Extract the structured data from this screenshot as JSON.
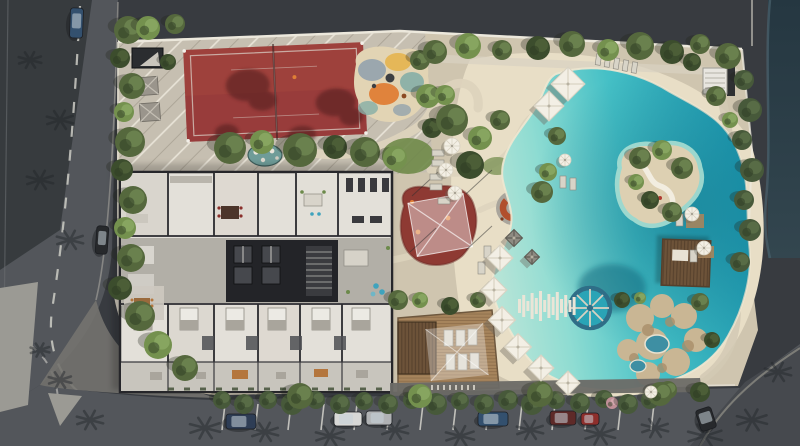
{
  "scene": {
    "kind": "aerial-architectural-rendering",
    "summary": "Top-down render of a residential amenity site: red sports court, playground, cut-away apartment floor plan, shade structures, fire-pit lounge, lagoon-style pool with island and round water feature, sun deck, rock grotto spa, perimeter streets with parked cars"
  },
  "labels": {
    "root": "aerial-site-render",
    "left_street": "left-street",
    "bottom_street": "bottom-street",
    "court": "sports-court",
    "playground": "playground",
    "pond": "pebble-pond",
    "shed": "garden-shed",
    "gazebos": "garden-gazebos",
    "building": "apartment-floorplan-cutaway",
    "red_canopy": "kids-play-area-shade-canopy",
    "firepit": "fire-pit-lounge",
    "pool": "lagoon-pool",
    "island": "pool-island",
    "wheel": "round-pool-feature",
    "planks": "plank-boardwalk",
    "grotto": "rock-grotto-spa",
    "pergola": "pergola",
    "deck": "sun-deck",
    "stairs": "stair-pavilion",
    "water": "waterway",
    "parking": "street-parking",
    "trees": "trees-and-shrubs",
    "cars": "parked-cars"
  },
  "palette": {
    "bgDark": "#383b40",
    "roofShadow": "#2f3237",
    "roadGrey": "#53565b",
    "roadShadow": "#33363a",
    "sidewalk": "#8f8e8a",
    "plaza": "#9b9a94",
    "waterStrip": "#2b3c46",
    "sand": "#cfc5af",
    "sandLight": "#ddd3bd",
    "pavingNW": "#c6bfb1",
    "beach": "#e8dec6",
    "courtRed": "#9e413c",
    "courtShadow": "#4f1f1d",
    "shedDark": "#2b2d30",
    "pondTeal": "#6f9c98",
    "playOrange": "#df7e36",
    "playTeal": "#86aea6",
    "playYellow": "#e6b44e",
    "playBlue": "#93a2ad",
    "redBlob": "#8e3a33",
    "firepitOrange": "#b14f2d",
    "poolShallow": "#bfe6d8",
    "poolMid": "#45c0c6",
    "poolDeep": "#1b96ae",
    "islandSand": "#ddd0b2",
    "wheelRim": "#2f6e87",
    "wheelFill": "#2aa4b6",
    "plankWhite": "#eae5d7",
    "rockTan": "#c9b694",
    "deckWood": "#a6845c",
    "pergolaBrown": "#6d5339",
    "canopyWhite": "#f3efe5",
    "canopyGrey": "#8e8b82",
    "bldgRoom": "#e3e0d9",
    "bldgWall": "#26262a",
    "corridor": "#b2afa7",
    "coreDark": "#232428",
    "terrace": "#c8c5bd",
    "treeMid": "#55683d",
    "treeLight": "#74914e",
    "treeDark": "#3c4d2d",
    "hedge": "#47593a",
    "lawn": "#6f8a49",
    "carNavy": "#2e3d55",
    "carWhite": "#d8d8d6",
    "carSilver": "#b0b2b4",
    "carBlue": "#33506e",
    "carRed": "#8e2f2c",
    "carDarkRed": "#5e2a28",
    "carDark": "#27292c",
    "lineWhite": "#cdccc6"
  },
  "trees": [
    [
      128,
      30,
      14,
      "m"
    ],
    [
      120,
      58,
      10,
      "d"
    ],
    [
      132,
      86,
      13,
      "m"
    ],
    [
      124,
      112,
      10,
      "l"
    ],
    [
      130,
      142,
      15,
      "m"
    ],
    [
      122,
      170,
      11,
      "d"
    ],
    [
      133,
      200,
      14,
      "m"
    ],
    [
      125,
      228,
      11,
      "l"
    ],
    [
      131,
      258,
      14,
      "m"
    ],
    [
      120,
      288,
      12,
      "d"
    ],
    [
      140,
      316,
      15,
      "m"
    ],
    [
      158,
      345,
      14,
      "l"
    ],
    [
      185,
      368,
      13,
      "m"
    ],
    [
      148,
      28,
      12,
      "l"
    ],
    [
      175,
      24,
      10,
      "m"
    ],
    [
      168,
      62,
      8,
      "d"
    ],
    [
      230,
      148,
      16,
      "m"
    ],
    [
      262,
      142,
      12,
      "l"
    ],
    [
      300,
      150,
      17,
      "m"
    ],
    [
      335,
      147,
      12,
      "d"
    ],
    [
      365,
      152,
      15,
      "m"
    ],
    [
      395,
      158,
      12,
      "l"
    ],
    [
      420,
      60,
      10,
      "m"
    ],
    [
      428,
      96,
      12,
      "l"
    ],
    [
      432,
      128,
      10,
      "d"
    ],
    [
      435,
      52,
      12,
      "m"
    ],
    [
      468,
      46,
      13,
      "l"
    ],
    [
      502,
      50,
      10,
      "m"
    ],
    [
      538,
      48,
      12,
      "d"
    ],
    [
      572,
      44,
      13,
      "m"
    ],
    [
      608,
      50,
      11,
      "l"
    ],
    [
      640,
      46,
      14,
      "m"
    ],
    [
      672,
      52,
      12,
      "d"
    ],
    [
      700,
      44,
      10,
      "m"
    ],
    [
      728,
      56,
      13,
      "m"
    ],
    [
      452,
      120,
      16,
      "m"
    ],
    [
      480,
      138,
      12,
      "l"
    ],
    [
      470,
      165,
      14,
      "d"
    ],
    [
      445,
      95,
      10,
      "l"
    ],
    [
      500,
      120,
      10,
      "m"
    ],
    [
      542,
      192,
      11,
      "m"
    ],
    [
      548,
      172,
      9,
      "l"
    ],
    [
      557,
      136,
      9,
      "m"
    ],
    [
      744,
      80,
      10,
      "h"
    ],
    [
      750,
      110,
      12,
      "h"
    ],
    [
      742,
      140,
      10,
      "h"
    ],
    [
      752,
      170,
      12,
      "h"
    ],
    [
      744,
      200,
      10,
      "h"
    ],
    [
      750,
      230,
      11,
      "h"
    ],
    [
      740,
      262,
      10,
      "h"
    ],
    [
      692,
      62,
      9,
      "d"
    ],
    [
      716,
      96,
      10,
      "m"
    ],
    [
      730,
      120,
      8,
      "l"
    ],
    [
      640,
      158,
      11,
      "m"
    ],
    [
      662,
      150,
      10,
      "l"
    ],
    [
      682,
      168,
      11,
      "m"
    ],
    [
      650,
      200,
      9,
      "d"
    ],
    [
      672,
      212,
      10,
      "m"
    ],
    [
      636,
      182,
      8,
      "l"
    ],
    [
      622,
      300,
      8,
      "d"
    ],
    [
      700,
      302,
      9,
      "m"
    ],
    [
      712,
      340,
      8,
      "d"
    ],
    [
      668,
      390,
      9,
      "m"
    ],
    [
      640,
      298,
      6,
      "l"
    ],
    [
      398,
      300,
      10,
      "m"
    ],
    [
      420,
      300,
      8,
      "l"
    ],
    [
      450,
      306,
      9,
      "d"
    ],
    [
      478,
      300,
      8,
      "m"
    ],
    [
      222,
      400,
      9,
      "h"
    ],
    [
      244,
      404,
      10,
      "h"
    ],
    [
      268,
      400,
      9,
      "h"
    ],
    [
      292,
      404,
      11,
      "h"
    ],
    [
      316,
      400,
      9,
      "h"
    ],
    [
      340,
      404,
      10,
      "h"
    ],
    [
      364,
      401,
      9,
      "h"
    ],
    [
      388,
      404,
      10,
      "h"
    ],
    [
      412,
      400,
      9,
      "h"
    ],
    [
      436,
      404,
      11,
      "h"
    ],
    [
      460,
      401,
      9,
      "h"
    ],
    [
      484,
      404,
      10,
      "h"
    ],
    [
      508,
      400,
      10,
      "h"
    ],
    [
      532,
      404,
      11,
      "h"
    ],
    [
      556,
      400,
      9,
      "h"
    ],
    [
      580,
      403,
      10,
      "h"
    ],
    [
      604,
      399,
      9,
      "h"
    ],
    [
      612,
      403,
      6,
      "p"
    ],
    [
      628,
      404,
      10,
      "h"
    ],
    [
      650,
      400,
      9,
      "h"
    ],
    [
      300,
      396,
      13,
      "m"
    ],
    [
      420,
      396,
      12,
      "l"
    ],
    [
      540,
      394,
      13,
      "m"
    ],
    [
      660,
      394,
      12,
      "m"
    ],
    [
      700,
      392,
      10,
      "d"
    ]
  ],
  "palm_shadows": [
    [
      205,
      428,
      16
    ],
    [
      265,
      432,
      14
    ],
    [
      330,
      436,
      15
    ],
    [
      395,
      430,
      14
    ],
    [
      460,
      436,
      15
    ],
    [
      530,
      430,
      14
    ],
    [
      600,
      434,
      16
    ],
    [
      655,
      428,
      14
    ],
    [
      705,
      436,
      18
    ],
    [
      752,
      420,
      16
    ],
    [
      778,
      372,
      14
    ],
    [
      60,
      380,
      12
    ],
    [
      90,
      420,
      14
    ],
    [
      40,
      350,
      10
    ],
    [
      60,
      120,
      14
    ],
    [
      40,
      180,
      14
    ],
    [
      70,
      240,
      14
    ],
    [
      30,
      60,
      12
    ]
  ],
  "cars": [
    {
      "x": 70,
      "y": 8,
      "w": 13,
      "h": 30,
      "color": "carBlue",
      "rot": 2
    },
    {
      "x": 96,
      "y": 226,
      "w": 12,
      "h": 28,
      "color": "carDark",
      "rot": 4
    },
    {
      "x": 226,
      "y": 414,
      "w": 30,
      "h": 15,
      "color": "carNavy",
      "rot": 0
    },
    {
      "x": 334,
      "y": 412,
      "w": 28,
      "h": 14,
      "color": "carWhite",
      "rot": 0
    },
    {
      "x": 366,
      "y": 411,
      "w": 26,
      "h": 14,
      "color": "carSilver",
      "rot": 0
    },
    {
      "x": 478,
      "y": 412,
      "w": 30,
      "h": 14,
      "color": "carBlue",
      "rot": 0
    },
    {
      "x": 550,
      "y": 411,
      "w": 26,
      "h": 14,
      "color": "carDarkRed",
      "rot": 0
    },
    {
      "x": 581,
      "y": 413,
      "w": 18,
      "h": 12,
      "color": "carRed",
      "rot": 0
    },
    {
      "x": 698,
      "y": 408,
      "w": 16,
      "h": 22,
      "color": "carDark",
      "rot": -18
    }
  ],
  "canopies": [
    [
      568,
      84,
      34,
      "w"
    ],
    [
      549,
      106,
      30,
      "w"
    ],
    [
      500,
      258,
      26,
      "w"
    ],
    [
      494,
      290,
      26,
      "w"
    ],
    [
      502,
      320,
      27,
      "w"
    ],
    [
      518,
      347,
      27,
      "w"
    ],
    [
      541,
      368,
      26,
      "w"
    ],
    [
      568,
      383,
      24,
      "w"
    ],
    [
      514,
      238,
      17,
      "g"
    ],
    [
      532,
      257,
      15,
      "g"
    ]
  ],
  "umbrellas": [
    [
      452,
      146,
      8
    ],
    [
      446,
      170,
      7
    ],
    [
      455,
      193,
      7
    ],
    [
      565,
      160,
      6
    ],
    [
      692,
      214,
      7
    ],
    [
      704,
      248,
      7
    ],
    [
      651,
      392,
      6
    ]
  ],
  "parking_tick_xs": [
    225,
    258,
    291,
    324,
    357,
    390,
    423,
    456,
    489,
    522,
    555,
    588,
    621,
    654
  ],
  "walk_tick_xs": [
    432,
    438,
    444,
    450,
    456,
    462,
    468,
    474
  ],
  "plank_heights": [
    14,
    22,
    10,
    26,
    16,
    30,
    12,
    24,
    18,
    28,
    14,
    22,
    12,
    18
  ]
}
